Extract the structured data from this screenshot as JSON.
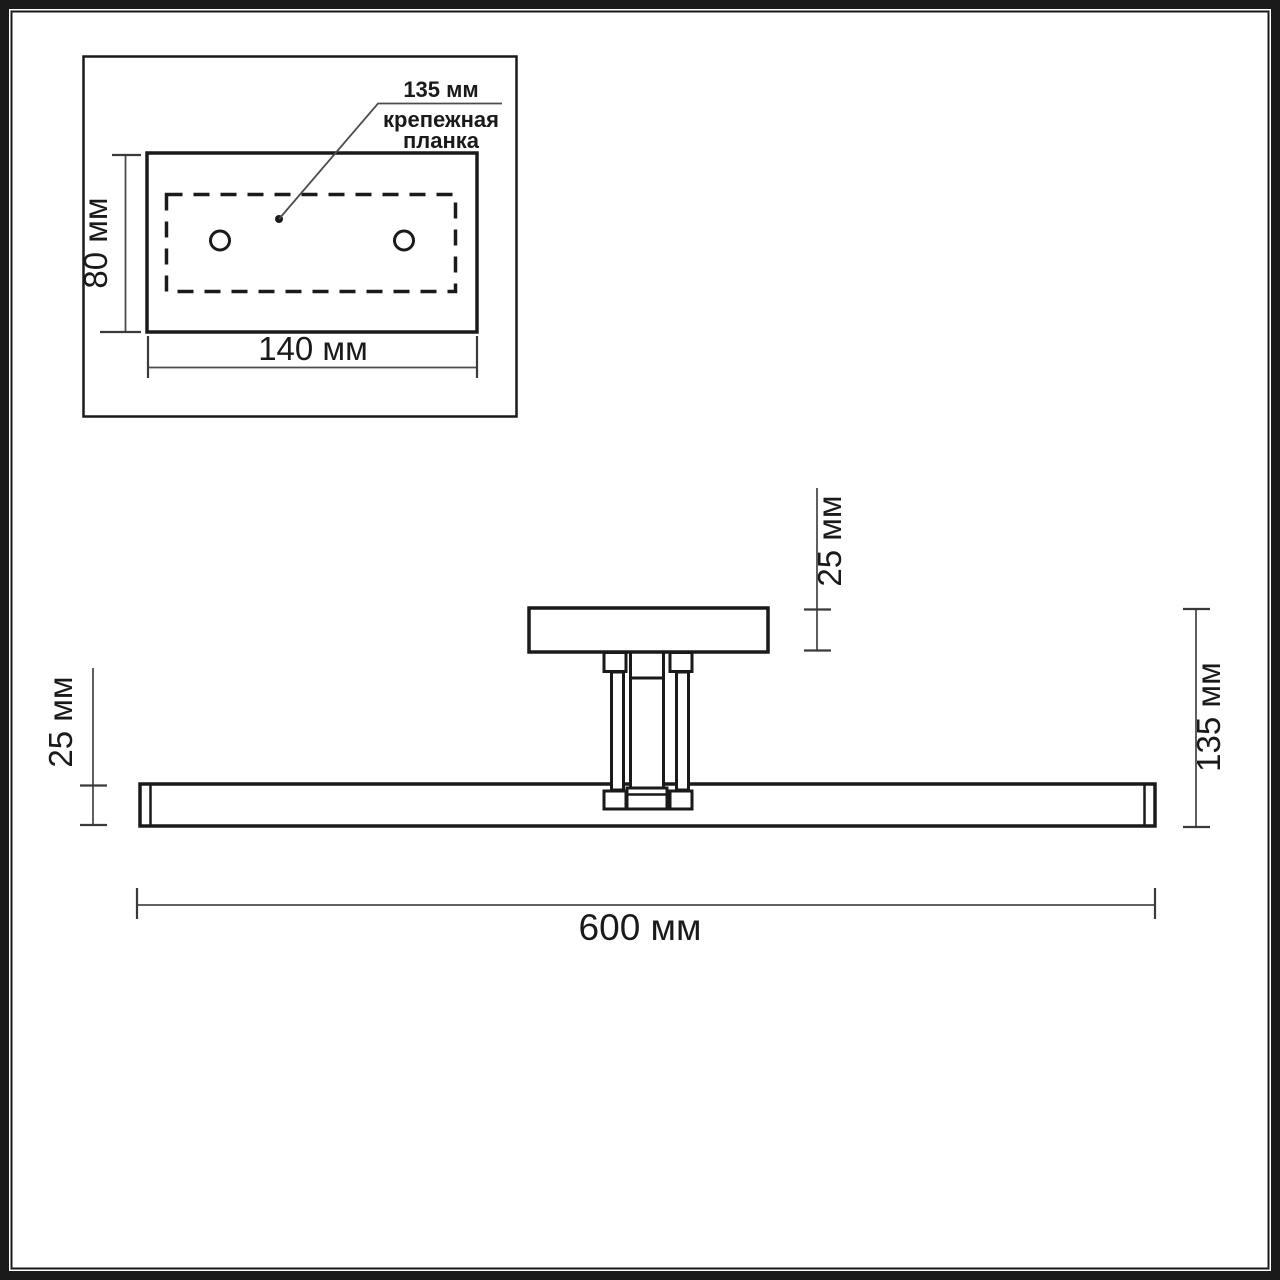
{
  "drawing": {
    "type": "technical-dimension-drawing",
    "units": "мм",
    "colors": {
      "line": "#1a1a1a",
      "dimension_line": "#4d4d4d",
      "background": "#ffffff"
    },
    "detail_view": {
      "description": "wall mounting plate top view",
      "hole_spacing": "135 мм",
      "caption_line1": "крепежная",
      "caption_line2": "планка",
      "height": "80 мм",
      "width": "140 мм"
    },
    "main_view": {
      "description": "lamp side view",
      "backplate_depth": "25 мм",
      "bar_thickness": "25 мм",
      "overall_depth": "135 мм",
      "length": "600 мм"
    }
  }
}
